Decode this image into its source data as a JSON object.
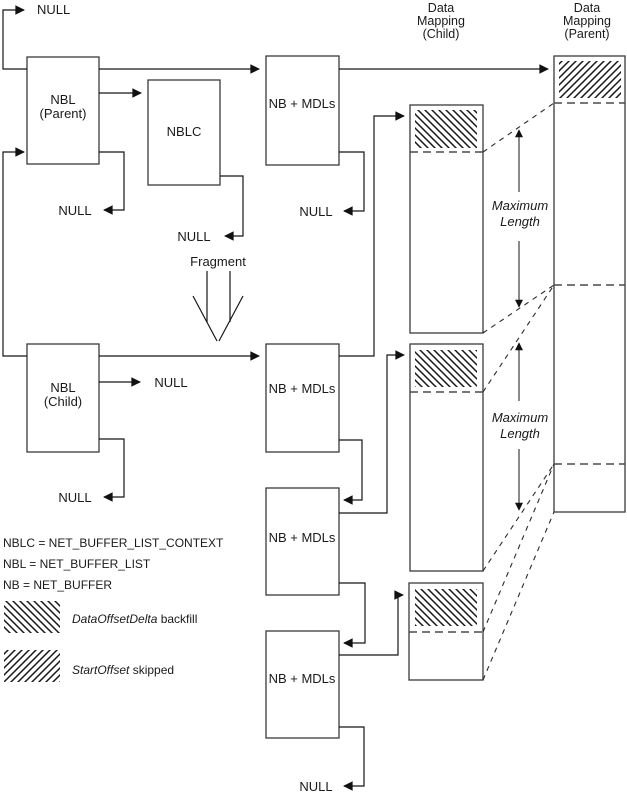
{
  "labels": {
    "null": "NULL",
    "fragment": "Fragment",
    "nbl_parent_line1": "NBL",
    "nbl_parent_line2": "(Parent)",
    "nbl_child_line1": "NBL",
    "nbl_child_line2": "(Child)",
    "nblc": "NBLC",
    "nb_mdls": "NB + MDLs",
    "maximum": "Maximum",
    "length": "Length"
  },
  "headers": {
    "child_line1": "Data",
    "child_line2": "Mapping",
    "child_line3": "(Child)",
    "parent_line1": "Data",
    "parent_line2": "Mapping",
    "parent_line3": "(Parent)"
  },
  "legend": {
    "abbrev1": "NBLC = NET_BUFFER_LIST_CONTEXT",
    "abbrev2": "NBL = NET_BUFFER_LIST",
    "abbrev3": "NB = NET_BUFFER",
    "backfill_term": "DataOffsetDelta",
    "backfill_rest": " backfill",
    "skipped_term": "StartOffset",
    "skipped_rest": " skipped"
  },
  "colors": {
    "background": "#ffffff",
    "line": "#161616",
    "box_border": "#3a3a3a"
  }
}
